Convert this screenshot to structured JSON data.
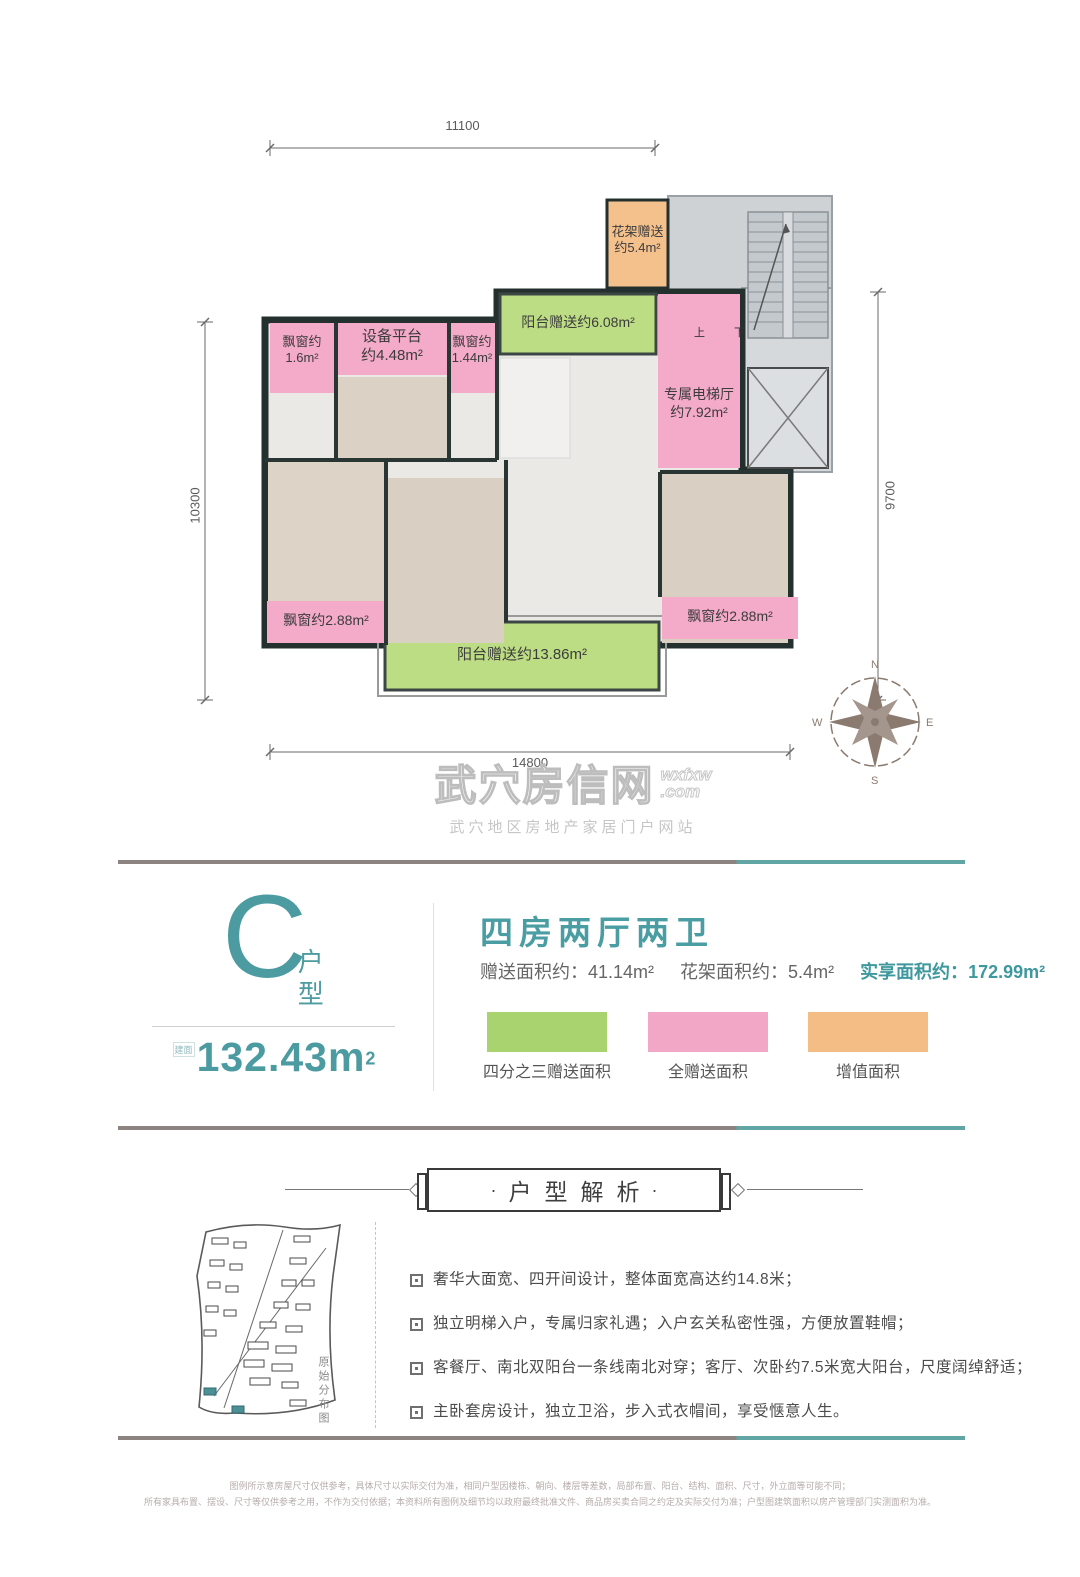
{
  "floor_plan": {
    "dimensions": {
      "top": "11100",
      "left": "10300",
      "right": "9700",
      "bottom": "14800"
    },
    "stairs": {
      "up": "上",
      "down": "下"
    },
    "compass": {
      "n": "N",
      "e": "E",
      "s": "S",
      "w": "W"
    },
    "zones": {
      "flower_rack": {
        "line1": "花架赠送",
        "line2": "约5.4m²",
        "color": "#f4c08c"
      },
      "bay_window_1": {
        "line1": "飘窗约",
        "line2": "1.6m²",
        "color": "#f4aac9"
      },
      "equipment_platform": {
        "line1": "设备平台",
        "line2": "约4.48m²",
        "color": "#f4aac9"
      },
      "bay_window_2": {
        "line1": "飘窗约",
        "line2": "1.44m²",
        "color": "#f4aac9"
      },
      "north_balcony": {
        "label": "阳台赠送约6.08m²",
        "color": "#bddd85"
      },
      "elevator_hall": {
        "line1": "专属电梯厅",
        "line2": "约7.92m²",
        "color": "#f4aac9"
      },
      "bay_window_3": {
        "label": "飘窗约2.88m²",
        "color": "#f4aac9"
      },
      "south_balcony": {
        "label": "阳台赠送约13.86m²",
        "color": "#bddd85"
      },
      "bay_window_4": {
        "label": "飘窗约2.88m²",
        "color": "#f4aac9"
      }
    }
  },
  "watermark": {
    "title": "武穴房信网",
    "domain_top": "wxfxw",
    "domain_bottom": ".com",
    "subtitle": "武穴地区房地产家居门户网站"
  },
  "unit": {
    "letter": "C",
    "type_label": "户型",
    "area_prefix": "建面",
    "area_value": "132.43m",
    "area_sup": "2"
  },
  "summary": {
    "headline": "四房两厅两卫",
    "stats": [
      {
        "label": "赠送面积约：",
        "value": "41.14m²"
      },
      {
        "label": "花架面积约：",
        "value": "5.4m²"
      },
      {
        "label": "实享面积约：",
        "value": "172.99m²"
      }
    ],
    "legend": [
      {
        "label": "四分之三赠送面积",
        "color": "#a9d36e"
      },
      {
        "label": "全赠送面积",
        "color": "#f3a7c6"
      },
      {
        "label": "增值面积",
        "color": "#f3bd85"
      }
    ]
  },
  "analysis": {
    "banner_dot": "·",
    "banner": "户型解析",
    "map_caption": "原始分布图",
    "bullets": [
      "奢华大面宽、四开间设计，整体面宽高达约14.8米；",
      "独立明梯入户，专属归家礼遇；入户玄关私密性强，方便放置鞋帽；",
      "客餐厅、南北双阳台一条线南北对穿；客厅、次卧约7.5米宽大阳台，尺度阔绰舒适；",
      "主卧套房设计，独立卫浴，步入式衣帽间，享受惬意人生。"
    ]
  },
  "footer": {
    "line1": "图例所示意房屋尺寸仅供参考，具体尺寸以实际交付为准，相同户型因楼栋、朝向、楼层等差数，局部布置、阳台、结构、面积、尺寸，外立面等可能不同；",
    "line2": "所有家具布置、摆设、尺寸等仅供参考之用，不作为交付依据；本资料所有图例及细节均以政府最终批准文件、商品房买卖合同之约定及实际交付为准；户型图建筑面积以房产管理部门实测面积为准。"
  }
}
